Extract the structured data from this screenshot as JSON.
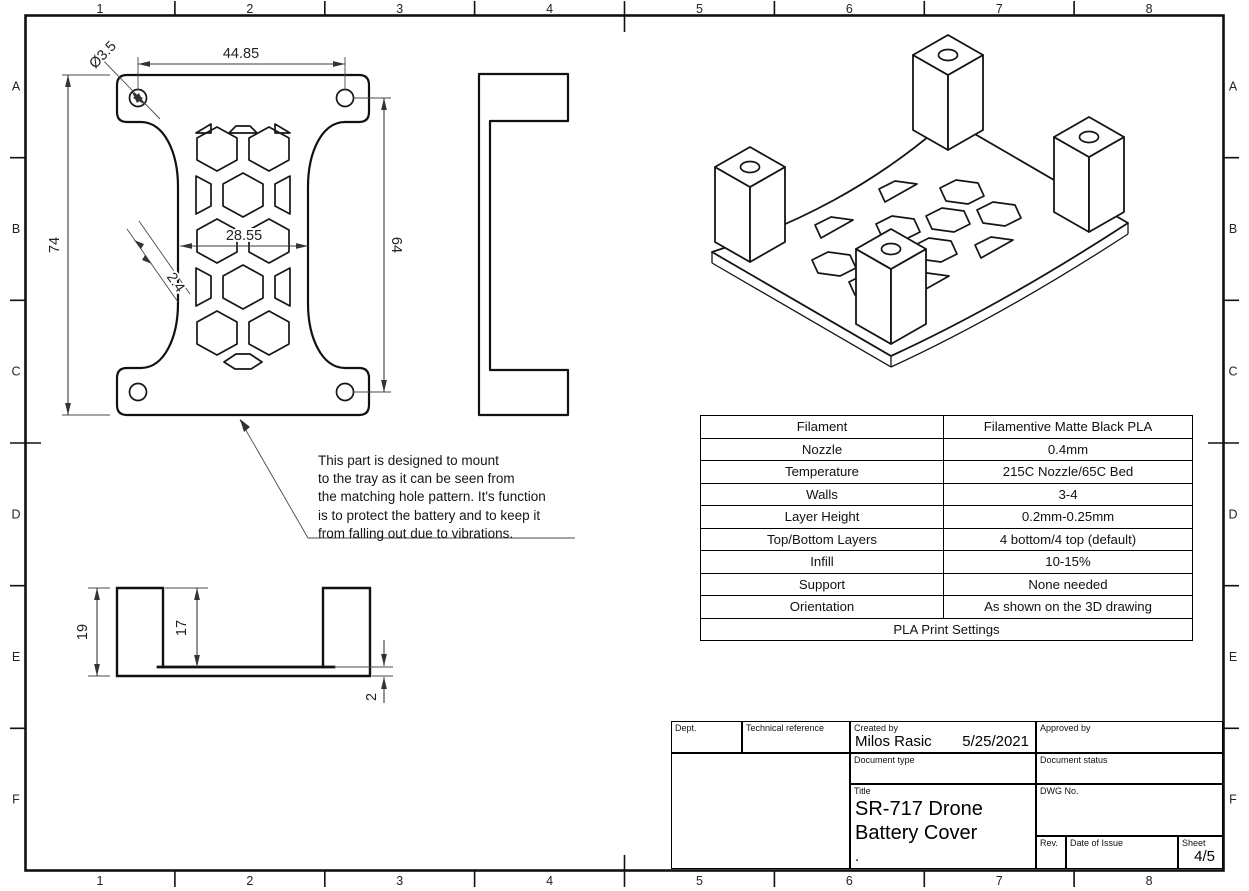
{
  "frame": {
    "column_labels": [
      "1",
      "2",
      "3",
      "4",
      "5",
      "6",
      "7",
      "8"
    ],
    "row_labels": [
      "A",
      "B",
      "C",
      "D",
      "E",
      "F"
    ]
  },
  "plan_view": {
    "dim_hole_diameter": "Ø3.5",
    "dim_hole_spacing_horizontal": "44.85",
    "dim_overall_height": "74",
    "dim_hole_spacing_vertical": "64",
    "dim_waist_width": "28.55",
    "dim_wall_thickness": "2.4"
  },
  "section_view": {
    "dim_overall_height": "19",
    "dim_inner_depth": "17",
    "dim_base_thickness": "2"
  },
  "note": {
    "lines": [
      "This part is designed to mount",
      "to the tray as it can be seen from",
      "the matching hole pattern. It's function",
      "is to protect the battery and to keep it",
      "from falling out due to vibrations."
    ]
  },
  "print_settings_table": {
    "rows": [
      {
        "label": "Filament",
        "value": "Filamentive Matte Black PLA"
      },
      {
        "label": "Nozzle",
        "value": "0.4mm"
      },
      {
        "label": "Temperature",
        "value": "215C Nozzle/65C Bed"
      },
      {
        "label": "Walls",
        "value": "3-4"
      },
      {
        "label": "Layer Height",
        "value": "0.2mm-0.25mm"
      },
      {
        "label": "Top/Bottom Layers",
        "value": "4 bottom/4 top (default)"
      },
      {
        "label": "Infill",
        "value": "10-15%"
      },
      {
        "label": "Support",
        "value": "None needed"
      },
      {
        "label": "Orientation",
        "value": "As shown on the 3D drawing"
      }
    ],
    "footer": "PLA Print Settings"
  },
  "title_block": {
    "dept_label": "Dept.",
    "technical_reference_label": "Technical reference",
    "created_by_label": "Created by",
    "created_by_value": "Milos Rasic",
    "created_date": "5/25/2021",
    "approved_by_label": "Approved by",
    "document_type_label": "Document type",
    "document_status_label": "Document status",
    "title_label": "Title",
    "title_line1": "SR-717 Drone",
    "title_line2": "Battery Cover",
    "title_line3": ".",
    "dwg_no_label": "DWG No.",
    "rev_label": "Rev.",
    "date_of_issue_label": "Date of Issue",
    "sheet_label": "Sheet",
    "sheet_value": "4/5"
  },
  "colors": {
    "line": "#111111",
    "background": "#ffffff"
  }
}
